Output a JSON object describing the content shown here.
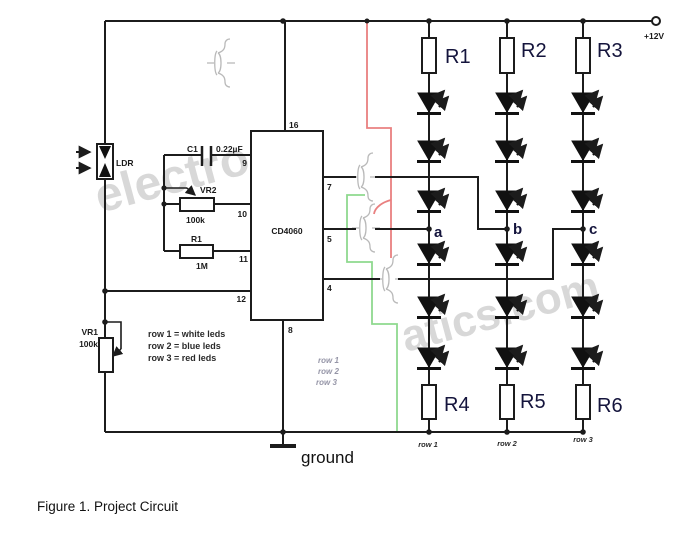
{
  "figure": {
    "caption": "Figure 1. Project Circuit"
  },
  "power": {
    "label": "+12V"
  },
  "ground_label": "ground",
  "ic": {
    "name": "CD4060",
    "pins": {
      "p4": "4",
      "p5": "5",
      "p7": "7",
      "p8": "8",
      "p9": "9",
      "p10": "10",
      "p11": "11",
      "p12": "12",
      "p16": "16"
    }
  },
  "ldr": {
    "label": "LDR"
  },
  "timing": {
    "c1": {
      "name": "C1",
      "value": "0.22µF"
    },
    "vr2": {
      "name": "VR2",
      "value": "100k"
    },
    "r1": {
      "name": "R1",
      "value": "1M"
    }
  },
  "vr1": {
    "name": "VR1",
    "value": "100k"
  },
  "legend": {
    "line1": "row 1 = white leds",
    "line2": "row 2 = blue leds",
    "line3": "row 3 = red leds"
  },
  "faint_rows": {
    "row1": "row 1",
    "row2": "row 2",
    "row3": "row 3"
  },
  "led_columns": {
    "top_resistors": {
      "c1": "R1",
      "c2": "R2",
      "c3": "R3"
    },
    "bottom_resistors": {
      "c1": "R4",
      "c2": "R5",
      "c3": "R6"
    },
    "nodes": {
      "a": "a",
      "b": "b",
      "c": "c"
    },
    "row_labels": {
      "c1": "row 1",
      "c2": "row 2",
      "c3": "row 3"
    }
  },
  "watermark": {
    "part1": "electro",
    "part2": "atics.com"
  },
  "colors": {
    "wire": "#1c1c1c",
    "red_wire": "#e98080",
    "green_wire": "#8fd98f",
    "label_ink": "#14143c"
  }
}
